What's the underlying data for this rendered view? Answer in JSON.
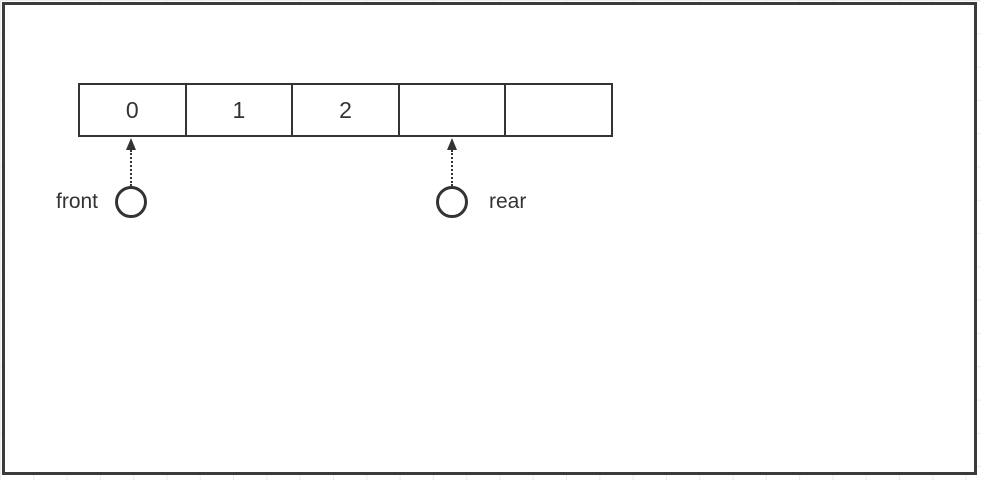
{
  "queue": {
    "cells": [
      "0",
      "1",
      "2",
      "",
      ""
    ]
  },
  "pointers": {
    "front": {
      "label": "front",
      "points_to_cell_index": 0
    },
    "rear": {
      "label": "rear",
      "points_to_cell_index": 3
    }
  },
  "colors": {
    "line": "#333333",
    "frame_border": "#3b3b3d",
    "grid": "#ebebeb",
    "background": "#ffffff"
  }
}
